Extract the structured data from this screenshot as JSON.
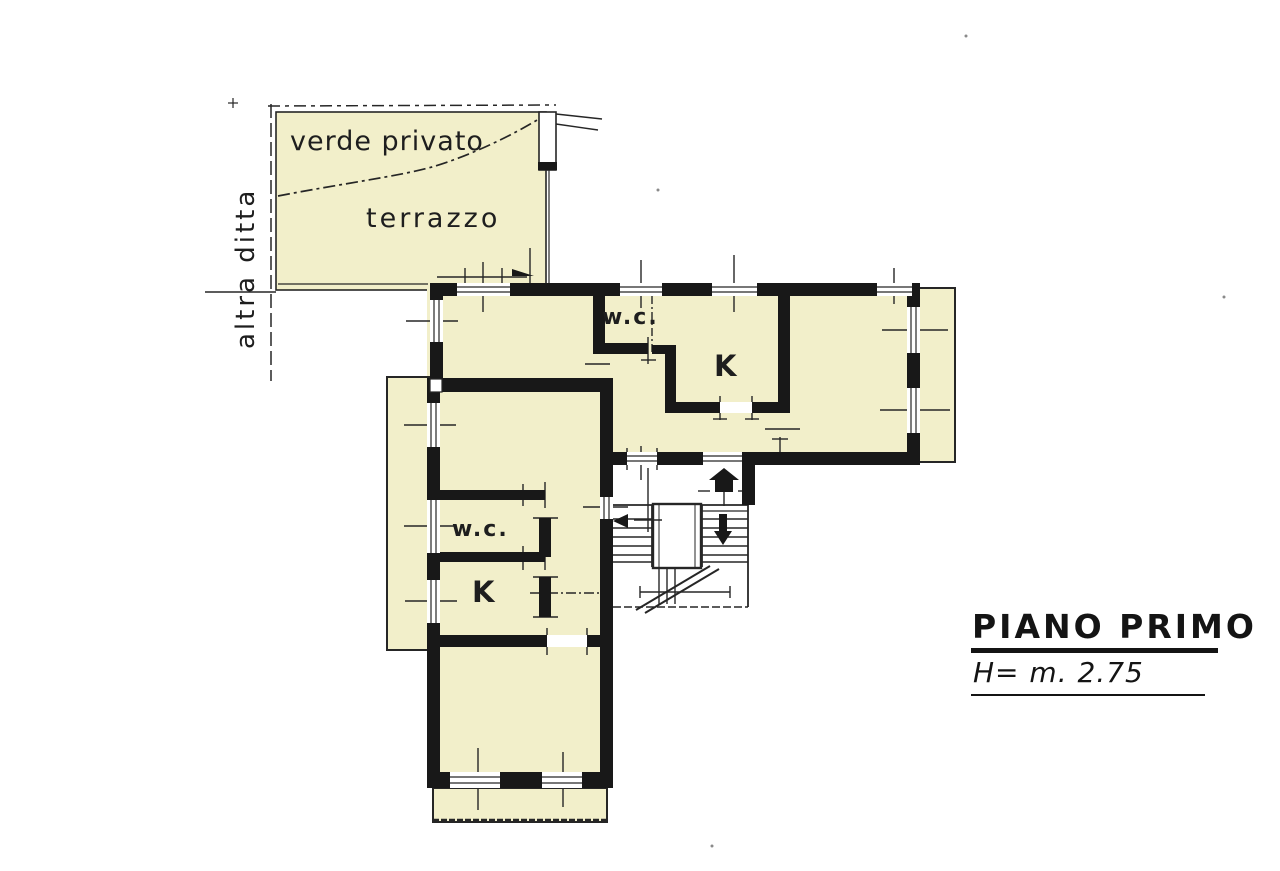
{
  "plan": {
    "labels": {
      "altra_ditta": "altra ditta",
      "verde_privato": "verde privato",
      "terrazzo": "terrazzo",
      "wc_top": "w.c.",
      "kitchen_top": "K",
      "wc_bottom": "w.c.",
      "kitchen_bottom": "K"
    },
    "title": "PIANO PRIMO",
    "height_note": "H= m. 2.75",
    "icons": {
      "entrance_arrow": "up-pentagon-arrow",
      "stair_down_arrow": "down-triangle-arrow",
      "stair_start_arrow": "left-triangle-arrow"
    },
    "colors": {
      "room_fill": "#f2efca",
      "wall": "#181818",
      "line": "#262626",
      "background": "#ffffff"
    }
  }
}
